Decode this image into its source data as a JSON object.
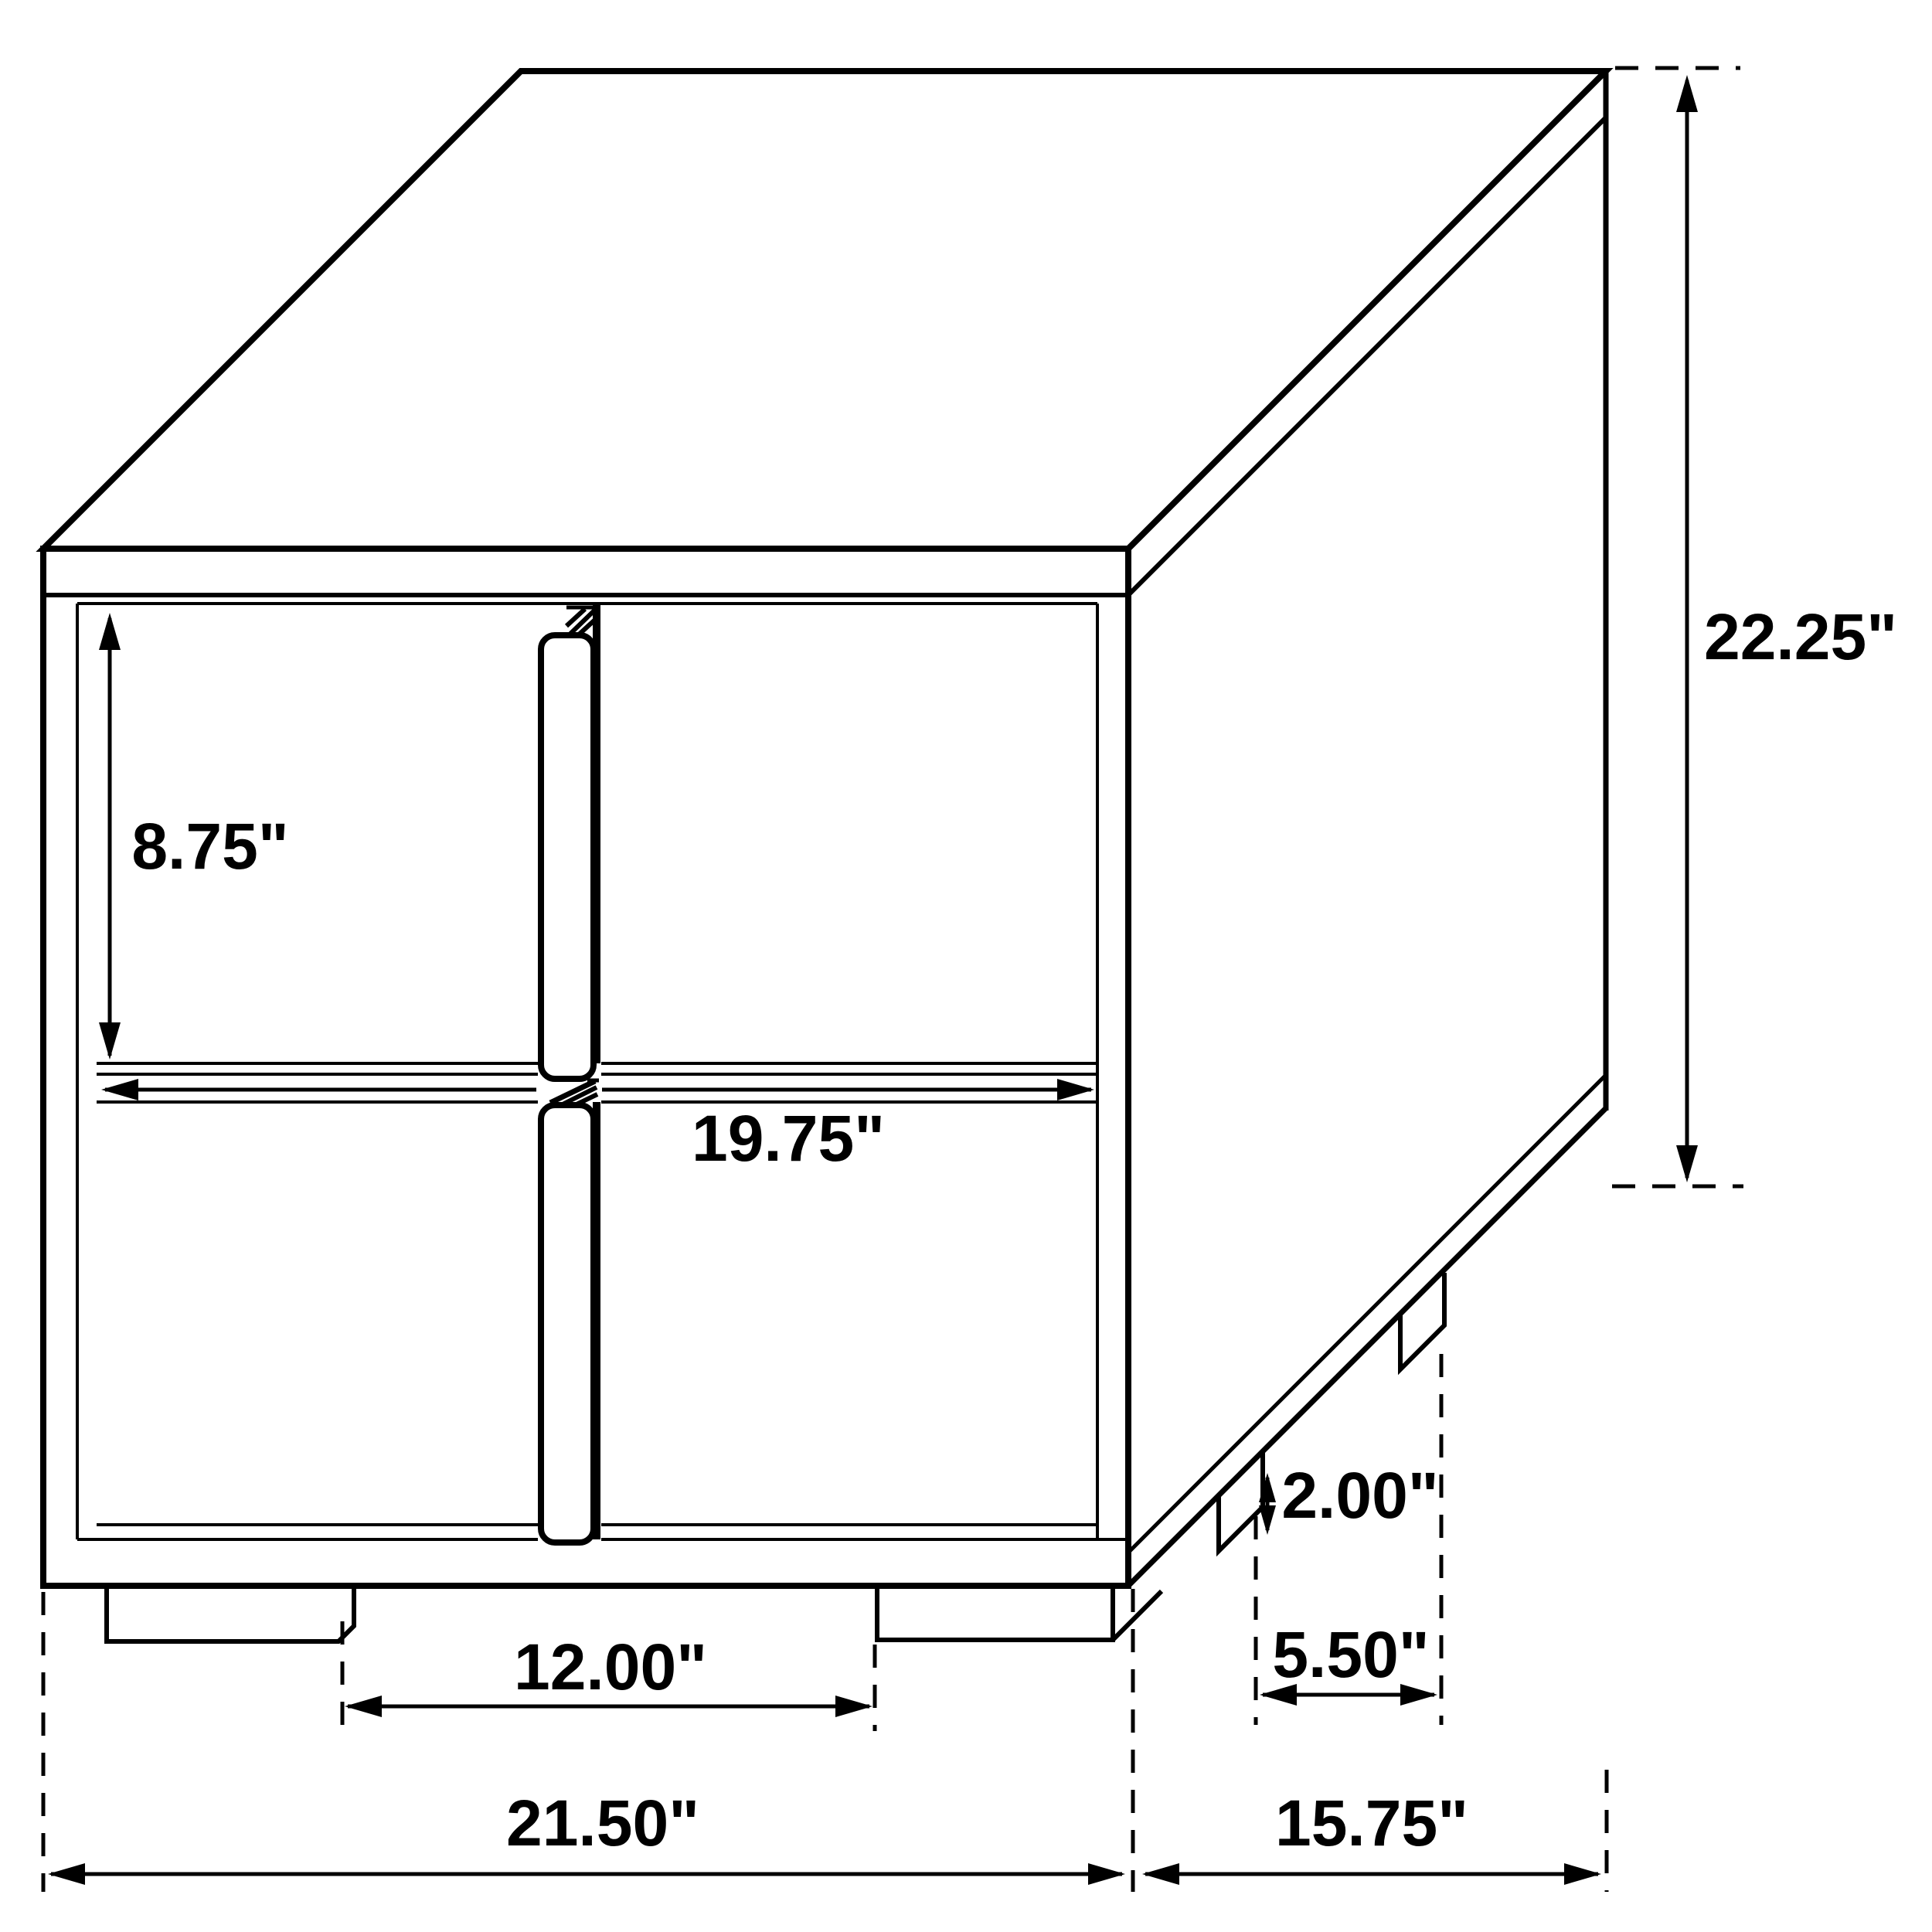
{
  "diagram": {
    "kind": "furniture-dimension-drawing",
    "background": "#ffffff",
    "line_color": "#000000",
    "dimensions": {
      "drawer_front_height": {
        "label": "8.75\"",
        "value": 8.75
      },
      "drawer_front_width": {
        "label": "19.75\"",
        "value": 19.75
      },
      "overall_height": {
        "label": "22.25\"",
        "value": 22.25
      },
      "front_feet_spacing": {
        "label": "12.00\"",
        "value": 12.0
      },
      "foot_height": {
        "label": "2.00\"",
        "value": 2.0
      },
      "side_feet_spacing": {
        "label": "5.50\"",
        "value": 5.5
      },
      "overall_width": {
        "label": "21.50\"",
        "value": 21.5
      },
      "overall_depth": {
        "label": "15.75\"",
        "value": 15.75
      }
    }
  }
}
